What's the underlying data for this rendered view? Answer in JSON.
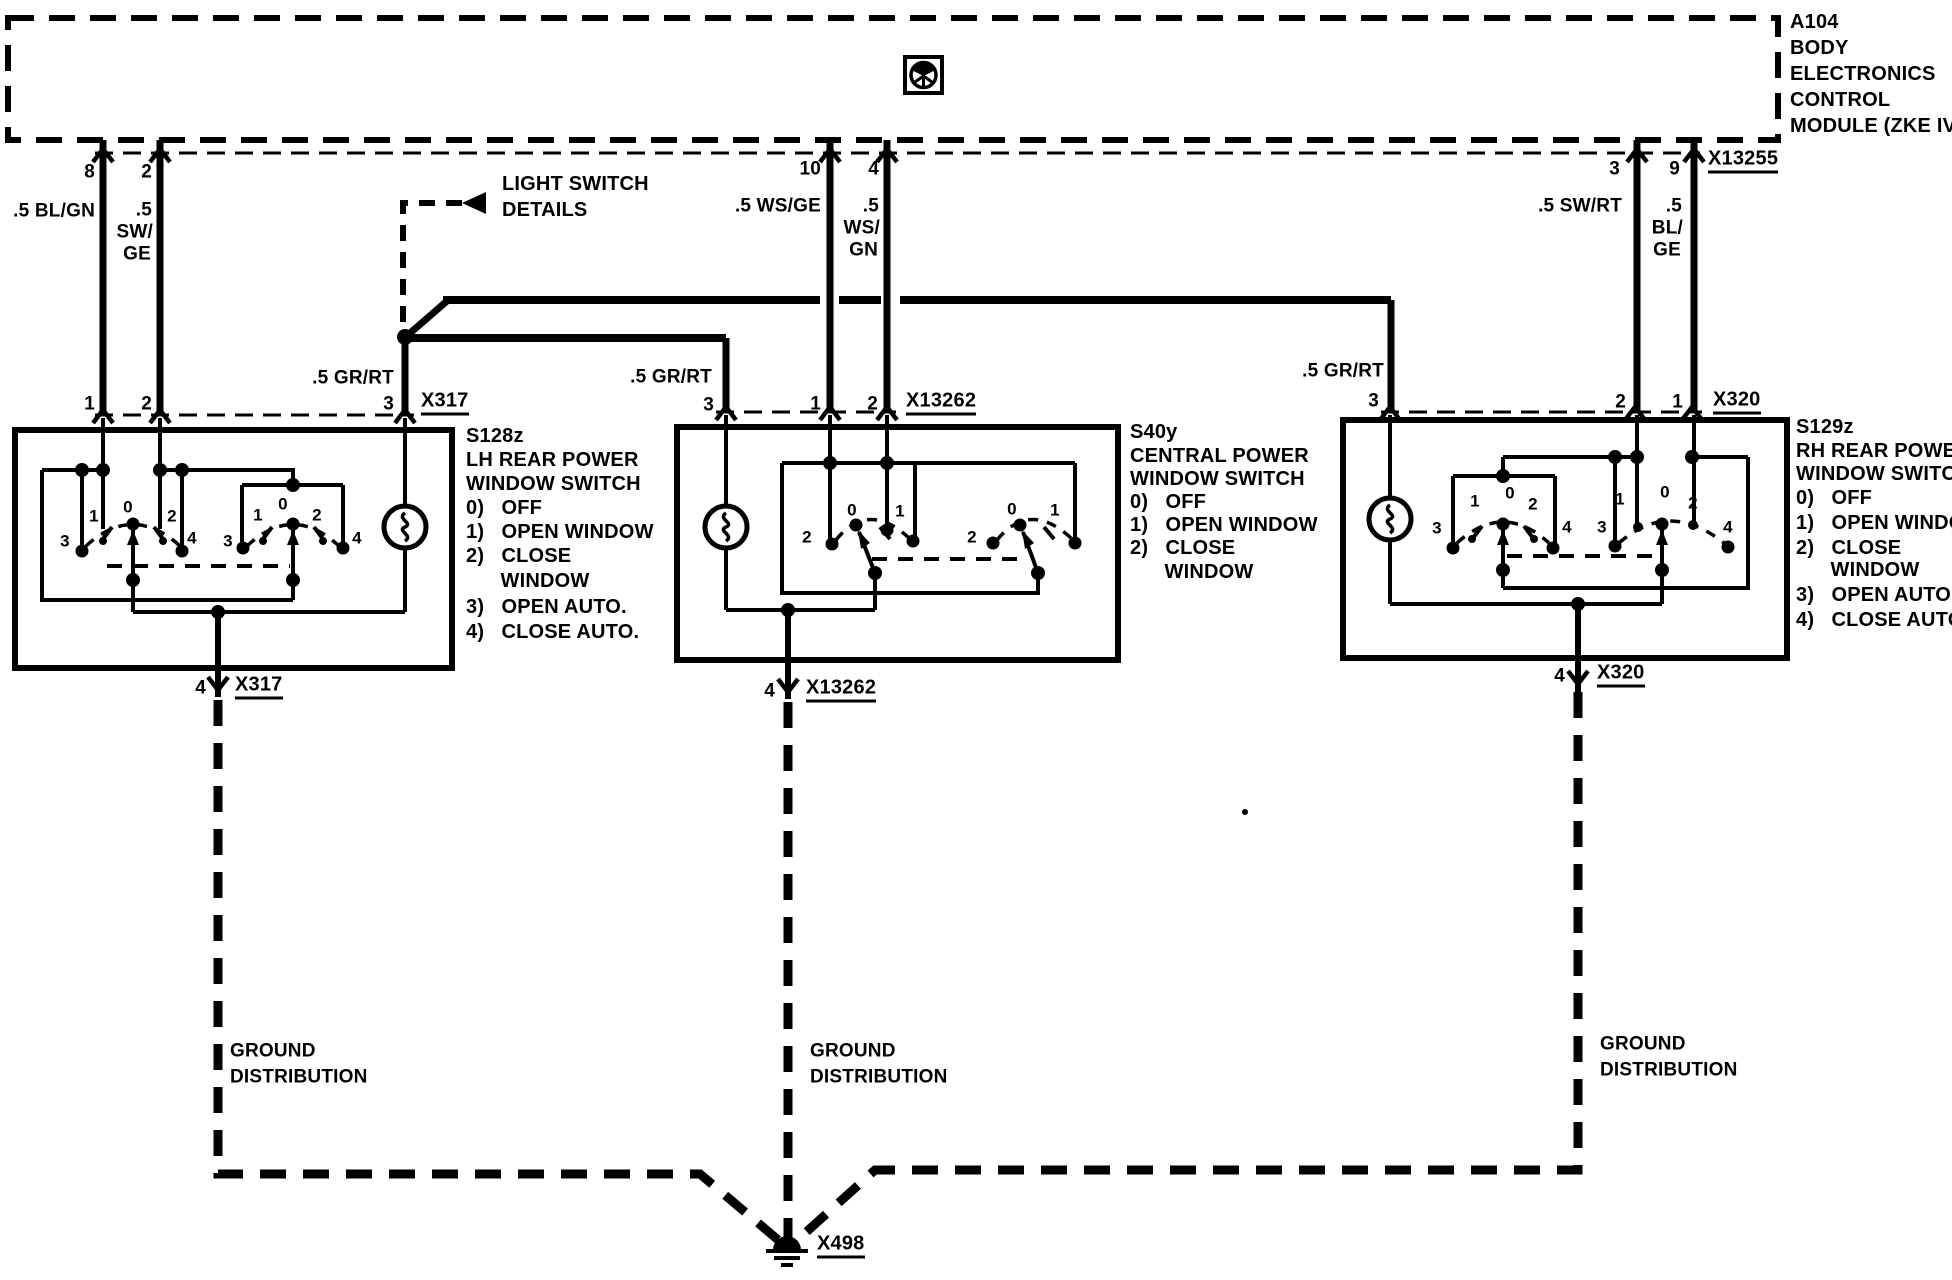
{
  "colors": {
    "ink": "#000000",
    "paper": "#ffffff"
  },
  "diagram": {
    "module_name": "A104 BODY ELECTRONICS CONTROL MODULE (ZKE IV)",
    "components": [
      "A104",
      "S128z",
      "S40y",
      "S129z"
    ],
    "connectors": [
      "X13255",
      "X317",
      "X13262",
      "X320",
      "X498"
    ],
    "labels": [
      {
        "n": "a104-id",
        "t": "A104",
        "x": 1790,
        "y": 22
      },
      {
        "n": "a104-line-body",
        "t": "BODY",
        "x": 1790,
        "y": 48
      },
      {
        "n": "a104-line-electronics",
        "t": "ELECTRONICS",
        "x": 1790,
        "y": 74
      },
      {
        "n": "a104-line-control",
        "t": "CONTROL",
        "x": 1790,
        "y": 100
      },
      {
        "n": "a104-line-module",
        "t": "MODULE (ZKE IV)",
        "x": 1790,
        "y": 126
      },
      {
        "n": "a104-pin-8",
        "t": "8",
        "x": 95,
        "y": 172,
        "a": "r",
        "fs": 19
      },
      {
        "n": "a104-pin-2",
        "t": "2",
        "x": 152,
        "y": 172,
        "a": "r",
        "fs": 19
      },
      {
        "n": "wire-bl-gn",
        "t": ".5 BL/GN",
        "x": 95,
        "y": 211,
        "a": "r",
        "fs": 19
      },
      {
        "n": "wire-sw-ge-1",
        "t": ".5",
        "x": 152,
        "y": 210,
        "a": "r",
        "fs": 19
      },
      {
        "n": "wire-sw-ge-2",
        "t": "SW/",
        "x": 153,
        "y": 232,
        "a": "r",
        "fs": 19
      },
      {
        "n": "wire-sw-ge-3",
        "t": "GE",
        "x": 151,
        "y": 254,
        "a": "r",
        "fs": 19
      },
      {
        "n": "a104-pin-10",
        "t": "10",
        "x": 821,
        "y": 169,
        "a": "r",
        "fs": 19
      },
      {
        "n": "a104-pin-4",
        "t": "4",
        "x": 879,
        "y": 169,
        "a": "r",
        "fs": 19
      },
      {
        "n": "wire-ws-ge",
        "t": ".5 WS/GE",
        "x": 821,
        "y": 206,
        "a": "r",
        "fs": 19
      },
      {
        "n": "wire-ws-gn-1",
        "t": ".5",
        "x": 879,
        "y": 206,
        "a": "r",
        "fs": 19
      },
      {
        "n": "wire-ws-gn-2",
        "t": "WS/",
        "x": 880,
        "y": 228,
        "a": "r",
        "fs": 19
      },
      {
        "n": "wire-ws-gn-3",
        "t": "GN",
        "x": 878,
        "y": 250,
        "a": "r",
        "fs": 19
      },
      {
        "n": "a104-pin-3",
        "t": "3",
        "x": 1620,
        "y": 169,
        "a": "r",
        "fs": 19
      },
      {
        "n": "a104-pin-9",
        "t": "9",
        "x": 1680,
        "y": 169,
        "a": "r",
        "fs": 19
      },
      {
        "n": "wire-sw-rt",
        "t": ".5 SW/RT",
        "x": 1622,
        "y": 206,
        "a": "r",
        "fs": 19
      },
      {
        "n": "wire-bl-ge-1",
        "t": ".5",
        "x": 1682,
        "y": 206,
        "a": "r",
        "fs": 19
      },
      {
        "n": "wire-bl-ge-2",
        "t": "BL/",
        "x": 1683,
        "y": 228,
        "a": "r",
        "fs": 19
      },
      {
        "n": "wire-bl-ge-3",
        "t": "GE",
        "x": 1681,
        "y": 250,
        "a": "r",
        "fs": 19
      },
      {
        "n": "connector-x13255",
        "t": "X13255",
        "x": 1708,
        "y": 161,
        "u": true
      },
      {
        "n": "light-switch-ref-1",
        "t": "LIGHT SWITCH",
        "x": 502,
        "y": 184
      },
      {
        "n": "light-switch-ref-2",
        "t": "DETAILS",
        "x": 502,
        "y": 210
      },
      {
        "n": "wire-gr-rt-left",
        "t": ".5 GR/RT",
        "x": 394,
        "y": 378,
        "a": "r",
        "fs": 19
      },
      {
        "n": "wire-gr-rt-center",
        "t": ".5 GR/RT",
        "x": 712,
        "y": 377,
        "a": "r",
        "fs": 19
      },
      {
        "n": "wire-gr-rt-right",
        "t": ".5 GR/RT",
        "x": 1384,
        "y": 371,
        "a": "r",
        "fs": 19
      },
      {
        "n": "s128z-pin-1",
        "t": "1",
        "x": 95,
        "y": 404,
        "a": "r",
        "fs": 19
      },
      {
        "n": "s128z-pin-2",
        "t": "2",
        "x": 152,
        "y": 404,
        "a": "r",
        "fs": 19
      },
      {
        "n": "s128z-pin-3",
        "t": "3",
        "x": 394,
        "y": 404,
        "a": "r",
        "fs": 19
      },
      {
        "n": "connector-x317-top",
        "t": "X317",
        "x": 421,
        "y": 403,
        "u": true
      },
      {
        "n": "s40y-pin-3",
        "t": "3",
        "x": 714,
        "y": 405,
        "a": "r",
        "fs": 19
      },
      {
        "n": "s40y-pin-1",
        "t": "1",
        "x": 821,
        "y": 404,
        "a": "r",
        "fs": 19
      },
      {
        "n": "s40y-pin-2",
        "t": "2",
        "x": 878,
        "y": 404,
        "a": "r",
        "fs": 19
      },
      {
        "n": "connector-x13262-top",
        "t": "X13262",
        "x": 906,
        "y": 403,
        "u": true
      },
      {
        "n": "s129z-pin-3",
        "t": "3",
        "x": 1379,
        "y": 401,
        "a": "r",
        "fs": 19
      },
      {
        "n": "s129z-pin-2",
        "t": "2",
        "x": 1626,
        "y": 402,
        "a": "r",
        "fs": 19
      },
      {
        "n": "s129z-pin-1",
        "t": "1",
        "x": 1683,
        "y": 402,
        "a": "r",
        "fs": 19
      },
      {
        "n": "connector-x320-top",
        "t": "X320",
        "x": 1713,
        "y": 402,
        "u": true
      },
      {
        "n": "s128z-title",
        "t": "S128z",
        "x": 466,
        "y": 436
      },
      {
        "n": "s128z-line-2",
        "t": "LH REAR POWER",
        "x": 466,
        "y": 460
      },
      {
        "n": "s128z-line-3",
        "t": "WINDOW SWITCH",
        "x": 466,
        "y": 484
      },
      {
        "n": "s128z-pos-0",
        "t": "0)   OFF",
        "x": 466,
        "y": 508
      },
      {
        "n": "s128z-pos-1",
        "t": "1)   OPEN WINDOW",
        "x": 466,
        "y": 532
      },
      {
        "n": "s128z-pos-2",
        "t": "2)   CLOSE",
        "x": 466,
        "y": 556
      },
      {
        "n": "s128z-pos-2b",
        "t": "      WINDOW",
        "x": 466,
        "y": 581
      },
      {
        "n": "s128z-pos-3",
        "t": "3)   OPEN AUTO.",
        "x": 466,
        "y": 607
      },
      {
        "n": "s128z-pos-4",
        "t": "4)   CLOSE AUTO.",
        "x": 466,
        "y": 632
      },
      {
        "n": "s40y-title",
        "t": "S40y",
        "x": 1130,
        "y": 432
      },
      {
        "n": "s40y-line-2",
        "t": "CENTRAL POWER",
        "x": 1130,
        "y": 456
      },
      {
        "n": "s40y-line-3",
        "t": "WINDOW SWITCH",
        "x": 1130,
        "y": 479
      },
      {
        "n": "s40y-pos-0",
        "t": "0)   OFF",
        "x": 1130,
        "y": 502
      },
      {
        "n": "s40y-pos-1",
        "t": "1)   OPEN WINDOW",
        "x": 1130,
        "y": 525
      },
      {
        "n": "s40y-pos-2",
        "t": "2)   CLOSE",
        "x": 1130,
        "y": 548
      },
      {
        "n": "s40y-pos-2b",
        "t": "      WINDOW",
        "x": 1130,
        "y": 572
      },
      {
        "n": "s129z-title",
        "t": "S129z",
        "x": 1796,
        "y": 427
      },
      {
        "n": "s129z-line-2",
        "t": "RH REAR POWER",
        "x": 1796,
        "y": 451
      },
      {
        "n": "s129z-line-3",
        "t": "WINDOW SWITCH",
        "x": 1796,
        "y": 474
      },
      {
        "n": "s129z-pos-0",
        "t": "0)   OFF",
        "x": 1796,
        "y": 498
      },
      {
        "n": "s129z-pos-1",
        "t": "1)   OPEN WINDOW",
        "x": 1796,
        "y": 523
      },
      {
        "n": "s129z-pos-2",
        "t": "2)   CLOSE",
        "x": 1796,
        "y": 548
      },
      {
        "n": "s129z-pos-2b",
        "t": "      WINDOW",
        "x": 1796,
        "y": 570
      },
      {
        "n": "s129z-pos-3",
        "t": "3)   OPEN AUTO.",
        "x": 1796,
        "y": 595
      },
      {
        "n": "s129z-pos-4",
        "t": "4)   CLOSE AUTO.",
        "x": 1796,
        "y": 620
      },
      {
        "n": "switch-a-pos-3",
        "t": "3",
        "x": 65,
        "y": 541,
        "a": "c",
        "fs": 17
      },
      {
        "n": "switch-a-pos-1",
        "t": "1",
        "x": 94,
        "y": 516,
        "a": "c",
        "fs": 17
      },
      {
        "n": "switch-a-pos-0",
        "t": "0",
        "x": 128,
        "y": 507,
        "a": "c",
        "fs": 17
      },
      {
        "n": "switch-a-pos-2",
        "t": "2",
        "x": 172,
        "y": 516,
        "a": "c",
        "fs": 17
      },
      {
        "n": "switch-a-pos-4",
        "t": "4",
        "x": 192,
        "y": 538,
        "a": "c",
        "fs": 17
      },
      {
        "n": "switch-b-pos-3",
        "t": "3",
        "x": 228,
        "y": 541,
        "a": "c",
        "fs": 17
      },
      {
        "n": "switch-b-pos-1",
        "t": "1",
        "x": 258,
        "y": 515,
        "a": "c",
        "fs": 17
      },
      {
        "n": "switch-b-pos-0",
        "t": "0",
        "x": 283,
        "y": 504,
        "a": "c",
        "fs": 17
      },
      {
        "n": "switch-b-pos-2",
        "t": "2",
        "x": 317,
        "y": 515,
        "a": "c",
        "fs": 17
      },
      {
        "n": "switch-b-pos-4",
        "t": "4",
        "x": 357,
        "y": 538,
        "a": "c",
        "fs": 17
      },
      {
        "n": "switch-c-pos-2",
        "t": "2",
        "x": 807,
        "y": 537,
        "a": "c",
        "fs": 17
      },
      {
        "n": "switch-c-pos-0",
        "t": "0",
        "x": 852,
        "y": 510,
        "a": "c",
        "fs": 17
      },
      {
        "n": "switch-c-pos-1",
        "t": "1",
        "x": 900,
        "y": 511,
        "a": "c",
        "fs": 17
      },
      {
        "n": "switch-d-pos-2",
        "t": "2",
        "x": 972,
        "y": 537,
        "a": "c",
        "fs": 17
      },
      {
        "n": "switch-d-pos-0",
        "t": "0",
        "x": 1012,
        "y": 509,
        "a": "c",
        "fs": 17
      },
      {
        "n": "switch-d-pos-1",
        "t": "1",
        "x": 1055,
        "y": 510,
        "a": "c",
        "fs": 17
      },
      {
        "n": "switch-e-pos-3",
        "t": "3",
        "x": 1437,
        "y": 528,
        "a": "c",
        "fs": 17
      },
      {
        "n": "switch-e-pos-1",
        "t": "1",
        "x": 1475,
        "y": 501,
        "a": "c",
        "fs": 17
      },
      {
        "n": "switch-e-pos-0",
        "t": "0",
        "x": 1510,
        "y": 493,
        "a": "c",
        "fs": 17
      },
      {
        "n": "switch-e-pos-2",
        "t": "2",
        "x": 1533,
        "y": 504,
        "a": "c",
        "fs": 17
      },
      {
        "n": "switch-e-pos-4",
        "t": "4",
        "x": 1567,
        "y": 527,
        "a": "c",
        "fs": 17
      },
      {
        "n": "switch-f-pos-3",
        "t": "3",
        "x": 1602,
        "y": 527,
        "a": "c",
        "fs": 17
      },
      {
        "n": "switch-f-pos-1",
        "t": "1",
        "x": 1620,
        "y": 499,
        "a": "c",
        "fs": 17
      },
      {
        "n": "switch-f-pos-0",
        "t": "0",
        "x": 1665,
        "y": 492,
        "a": "c",
        "fs": 17
      },
      {
        "n": "switch-f-pos-2",
        "t": "2",
        "x": 1693,
        "y": 503,
        "a": "c",
        "fs": 17
      },
      {
        "n": "switch-f-pos-4",
        "t": "4",
        "x": 1728,
        "y": 527,
        "a": "c",
        "fs": 17
      },
      {
        "n": "s128z-pin-4",
        "t": "4",
        "x": 206,
        "y": 688,
        "a": "r",
        "fs": 19
      },
      {
        "n": "connector-x317-bottom",
        "t": "X317",
        "x": 235,
        "y": 687,
        "u": true
      },
      {
        "n": "s40y-pin-4",
        "t": "4",
        "x": 775,
        "y": 691,
        "a": "r",
        "fs": 19
      },
      {
        "n": "connector-x13262-bottom",
        "t": "X13262",
        "x": 806,
        "y": 690,
        "u": true
      },
      {
        "n": "s129z-pin-4",
        "t": "4",
        "x": 1565,
        "y": 676,
        "a": "r",
        "fs": 19
      },
      {
        "n": "connector-x320-bottom",
        "t": "X320",
        "x": 1597,
        "y": 675,
        "u": true
      },
      {
        "n": "ground-left-1",
        "t": "GROUND",
        "x": 230,
        "y": 1051,
        "fs": 19
      },
      {
        "n": "ground-left-2",
        "t": "DISTRIBUTION",
        "x": 230,
        "y": 1077,
        "fs": 19
      },
      {
        "n": "ground-center-1",
        "t": "GROUND",
        "x": 810,
        "y": 1051,
        "fs": 19
      },
      {
        "n": "ground-center-2",
        "t": "DISTRIBUTION",
        "x": 810,
        "y": 1077,
        "fs": 19
      },
      {
        "n": "ground-right-1",
        "t": "GROUND",
        "x": 1600,
        "y": 1044,
        "fs": 19
      },
      {
        "n": "ground-right-2",
        "t": "DISTRIBUTION",
        "x": 1600,
        "y": 1070,
        "fs": 19
      },
      {
        "n": "connector-x498",
        "t": "X498",
        "x": 817,
        "y": 1246,
        "u": true
      }
    ]
  }
}
